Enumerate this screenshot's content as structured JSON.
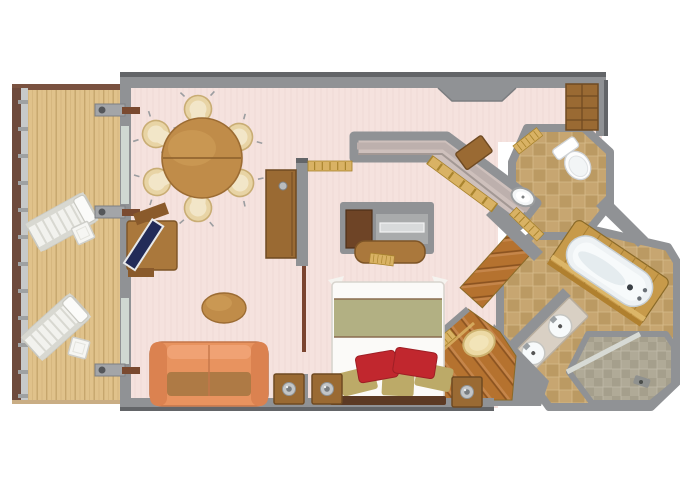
{
  "title": "Suite floor plan (top-down 3D render)",
  "rooms": [
    {
      "id": "balcony",
      "name": "balcony with wood deck and railing"
    },
    {
      "id": "living-room",
      "name": "living room with dining area"
    },
    {
      "id": "entry-hall",
      "name": "entry hallway"
    },
    {
      "id": "walk-in-closet",
      "name": "walk-in closet corridor"
    },
    {
      "id": "bedroom",
      "name": "bedroom"
    },
    {
      "id": "guest-wc",
      "name": "guest toilet room (octagonal)"
    },
    {
      "id": "bathroom",
      "name": "main bathroom with tub, double vanity and shower"
    }
  ],
  "furniture": [
    {
      "id": "dining-table",
      "name": "round dining table",
      "seats": 6
    },
    {
      "id": "dining-chairs",
      "name": "cream tub chairs",
      "count": 6
    },
    {
      "id": "desk-tv",
      "name": "desk with flat screen"
    },
    {
      "id": "coffee-table",
      "name": "oval coffee table"
    },
    {
      "id": "sofa",
      "name": "coral three-seat sofa"
    },
    {
      "id": "side-tables-lamps",
      "name": "side tables with lamps",
      "count": 3
    },
    {
      "id": "sideboard",
      "name": "tall wood sideboard"
    },
    {
      "id": "wardrobe",
      "name": "entry wardrobe cabinet"
    },
    {
      "id": "bed",
      "name": "double bed, olive runner, 2 red + 3 tan pillows"
    },
    {
      "id": "vanity-niche",
      "name": "bedroom TV niche with vanity desk"
    },
    {
      "id": "ottoman",
      "name": "cream ottoman"
    },
    {
      "id": "loungers",
      "name": "balcony loungers",
      "count": 2
    },
    {
      "id": "balcony-tables",
      "name": "balcony side tables",
      "count": 2
    },
    {
      "id": "toilet",
      "name": "toilet"
    },
    {
      "id": "wc-sink",
      "name": "small oval sink"
    },
    {
      "id": "bathtub",
      "name": "bathtub on wood platform"
    },
    {
      "id": "double-sinks",
      "name": "double sink vanity"
    },
    {
      "id": "shower",
      "name": "walk-in shower"
    }
  ],
  "colors": {
    "wall": "#909295",
    "wallDark": "#636568",
    "wallLight": "#a9a7a3",
    "carpet": "#f5e2de",
    "carpetStripe": "#eed9d5",
    "closetCarpet": "#cec0bc",
    "closetBench": "#bdb0ad",
    "deck": "#e0c28b",
    "deckLine": "#c6a66d",
    "railWood": "#6e4a3c",
    "railMetal": "#c7c9c9",
    "tile": "#c7a671",
    "tileAlt": "#bb9a63",
    "tileGrout": "#d6bb8a",
    "showerTile": "#b0aa97",
    "showerTileAlt": "#a59f8c",
    "glassLine": "#d7dad5",
    "wood": "#b5722f",
    "woodDark": "#8a5220",
    "woodLight": "#c5854a",
    "furnWood": "#9a6a33",
    "furnWoodDark": "#6f4a22",
    "deskWood": "#aa783c",
    "deskEdge": "#7d5426",
    "tableWood": "#c08c49",
    "tableEdge": "#9c6c33",
    "tableSeam": "#8a5e2a",
    "sofa": "#e8935f",
    "sofaDark": "#db8250",
    "sofaSeat": "#ae7a45",
    "sofaEdge": "#c4764a",
    "chairCream": "#e8d4a5",
    "chairEdge": "#c9ad74",
    "chairInner": "#f2e6c8",
    "bedWhite": "#fbfaf8",
    "bedEdge": "#d8d4ce",
    "bedBand": "#b2b083",
    "bandLine": "#8a6c50",
    "pillowRed": "#c1272e",
    "pillowRedDark": "#9e1f25",
    "pillowTan": "#bcaa68",
    "headboard": "#5c3a24",
    "fixWhite": "#f7fafb",
    "fixEdge": "#c9d0d4",
    "tubFill": "#eef2f4",
    "tubShadow": "#dde6ea",
    "marble": "#d9d0c4",
    "marbleEdge": "#b9ae9e",
    "gold": "#d9b264",
    "goldLine": "#a9842e",
    "tvNavy": "#222b58",
    "tvEdge": "#e8e9ea",
    "glass": "#cfd8d2",
    "lamp": "#c2c5c7",
    "lampDark": "#797d80",
    "platform": "#c79a4a",
    "platformLight": "#dcb668",
    "platformDark": "#b0802f",
    "whiteFurn": "#f2f2ee",
    "whiteFurnEdge": "#c9c9c2",
    "whiteFurnSlat": "#d8d8d1"
  }
}
